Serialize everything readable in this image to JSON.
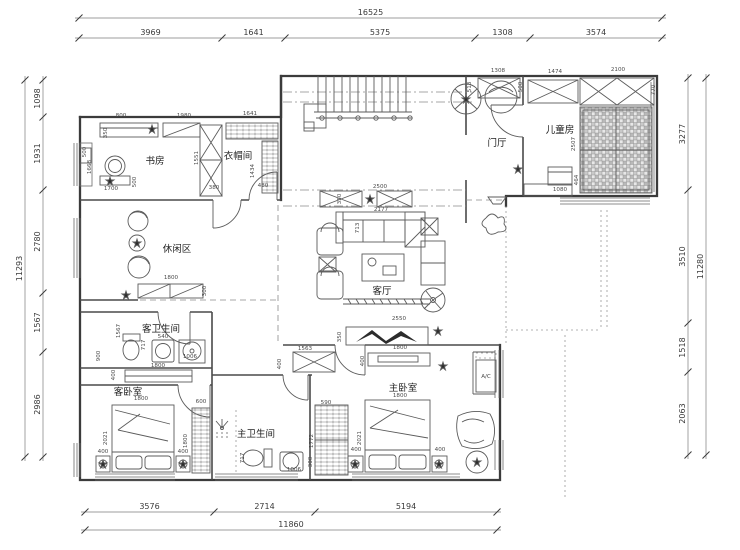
{
  "drawing": {
    "type": "residential-floor-plan",
    "units": "mm",
    "line_color": "#3b3b3b",
    "dim_color": "#4a4a4a"
  },
  "room_labels": [
    {
      "t": "书房",
      "x": 155,
      "y": 164
    },
    {
      "t": "衣帽间",
      "x": 238,
      "y": 159
    },
    {
      "t": "门厅",
      "x": 497,
      "y": 146
    },
    {
      "t": "儿童房",
      "x": 560,
      "y": 133
    },
    {
      "t": "休闲区",
      "x": 177,
      "y": 252
    },
    {
      "t": "客厅",
      "x": 382,
      "y": 294
    },
    {
      "t": "客卫生间",
      "x": 161,
      "y": 332
    },
    {
      "t": "客卧室",
      "x": 128,
      "y": 395
    },
    {
      "t": "主卫生间",
      "x": 256,
      "y": 437
    },
    {
      "t": "主卧室",
      "x": 403,
      "y": 391
    }
  ],
  "dim_totals": [
    {
      "dir": "h",
      "pos": 18,
      "from": 79,
      "to": 662,
      "label": "16525"
    },
    {
      "dir": "v",
      "pos": 25,
      "from": 80,
      "to": 457,
      "label": "11293"
    },
    {
      "dir": "v",
      "pos": 706,
      "from": 78,
      "to": 455,
      "label": "11280"
    },
    {
      "dir": "h",
      "pos": 530,
      "from": 85,
      "to": 497,
      "label": "11860"
    }
  ],
  "dim_chains": [
    {
      "dir": "h",
      "pos": 38,
      "ticks": [
        79,
        222,
        285,
        475,
        530,
        662
      ],
      "labels": [
        "3969",
        "1641",
        "5375",
        "1308",
        "3574"
      ]
    },
    {
      "dir": "v",
      "pos": 43,
      "ticks": [
        80,
        117,
        190,
        293,
        352,
        457
      ],
      "labels": [
        "1098",
        "1931",
        "2780",
        "1567",
        "2986"
      ]
    },
    {
      "dir": "v",
      "pos": 688,
      "ticks": [
        78,
        190,
        323,
        372,
        455
      ],
      "labels": [
        "3277",
        "3510",
        "1518",
        "2063"
      ]
    },
    {
      "dir": "h",
      "pos": 512,
      "ticks": [
        85,
        214,
        315,
        497
      ],
      "labels": [
        "3576",
        "2714",
        "5194"
      ]
    }
  ],
  "inner_dims": [
    {
      "t": "800",
      "x": 121,
      "y": 117
    },
    {
      "t": "350",
      "x": 107,
      "y": 133,
      "r": 1
    },
    {
      "t": "1980",
      "x": 184,
      "y": 117
    },
    {
      "t": "1641",
      "x": 250,
      "y": 115
    },
    {
      "t": "500",
      "x": 86,
      "y": 152,
      "r": 1
    },
    {
      "t": "1668",
      "x": 91,
      "y": 167,
      "r": 1
    },
    {
      "t": "1700",
      "x": 111,
      "y": 190
    },
    {
      "t": "500",
      "x": 136,
      "y": 182,
      "r": 1
    },
    {
      "t": "1551",
      "x": 198,
      "y": 158,
      "r": 1
    },
    {
      "t": "380",
      "x": 214,
      "y": 189
    },
    {
      "t": "1434",
      "x": 254,
      "y": 171,
      "r": 1
    },
    {
      "t": "480",
      "x": 263,
      "y": 187
    },
    {
      "t": "1308",
      "x": 498,
      "y": 72
    },
    {
      "t": "513",
      "x": 471,
      "y": 87,
      "r": 1
    },
    {
      "t": "1474",
      "x": 555,
      "y": 73
    },
    {
      "t": "2100",
      "x": 618,
      "y": 71
    },
    {
      "t": "500",
      "x": 522,
      "y": 87,
      "r": 1
    },
    {
      "t": "770",
      "x": 655,
      "y": 90,
      "r": 1
    },
    {
      "t": "2507",
      "x": 575,
      "y": 144,
      "r": 1
    },
    {
      "t": "1080",
      "x": 560,
      "y": 191
    },
    {
      "t": "464",
      "x": 578,
      "y": 180,
      "r": 1
    },
    {
      "t": "2500",
      "x": 380,
      "y": 188
    },
    {
      "t": "350",
      "x": 341,
      "y": 199,
      "r": 1
    },
    {
      "t": "2177",
      "x": 381,
      "y": 211
    },
    {
      "t": "713",
      "x": 359,
      "y": 228,
      "r": 1
    },
    {
      "t": "2550",
      "x": 399,
      "y": 320
    },
    {
      "t": "350",
      "x": 341,
      "y": 337,
      "r": 1
    },
    {
      "t": "1563",
      "x": 305,
      "y": 350
    },
    {
      "t": "400",
      "x": 281,
      "y": 364,
      "r": 1
    },
    {
      "t": "1800",
      "x": 400,
      "y": 349
    },
    {
      "t": "400",
      "x": 364,
      "y": 361,
      "r": 1
    },
    {
      "t": "1800",
      "x": 171,
      "y": 279
    },
    {
      "t": "300",
      "x": 206,
      "y": 291,
      "r": 1
    },
    {
      "t": "1567",
      "x": 120,
      "y": 331,
      "r": 1
    },
    {
      "t": "717",
      "x": 145,
      "y": 345,
      "r": 1
    },
    {
      "t": "540",
      "x": 163,
      "y": 338
    },
    {
      "t": "1006",
      "x": 190,
      "y": 358
    },
    {
      "t": "900",
      "x": 100,
      "y": 356,
      "r": 1
    },
    {
      "t": "1800",
      "x": 158,
      "y": 367
    },
    {
      "t": "400",
      "x": 115,
      "y": 375,
      "r": 1
    },
    {
      "t": "1800",
      "x": 141,
      "y": 400
    },
    {
      "t": "2021",
      "x": 107,
      "y": 438,
      "r": 1
    },
    {
      "t": "400",
      "x": 103,
      "y": 453
    },
    {
      "t": "400",
      "x": 183,
      "y": 453
    },
    {
      "t": "600",
      "x": 201,
      "y": 403
    },
    {
      "t": "1800",
      "x": 187,
      "y": 441,
      "r": 1
    },
    {
      "t": "717",
      "x": 244,
      "y": 458,
      "r": 1
    },
    {
      "t": "1006",
      "x": 294,
      "y": 471
    },
    {
      "t": "300",
      "x": 312,
      "y": 462,
      "r": 1
    },
    {
      "t": "590",
      "x": 326,
      "y": 404
    },
    {
      "t": "1772",
      "x": 313,
      "y": 441,
      "r": 1
    },
    {
      "t": "1800",
      "x": 400,
      "y": 397
    },
    {
      "t": "2021",
      "x": 361,
      "y": 438,
      "r": 1
    },
    {
      "t": "400",
      "x": 356,
      "y": 451
    },
    {
      "t": "400",
      "x": 440,
      "y": 451
    },
    {
      "t": "A/C",
      "x": 486,
      "y": 378
    }
  ]
}
